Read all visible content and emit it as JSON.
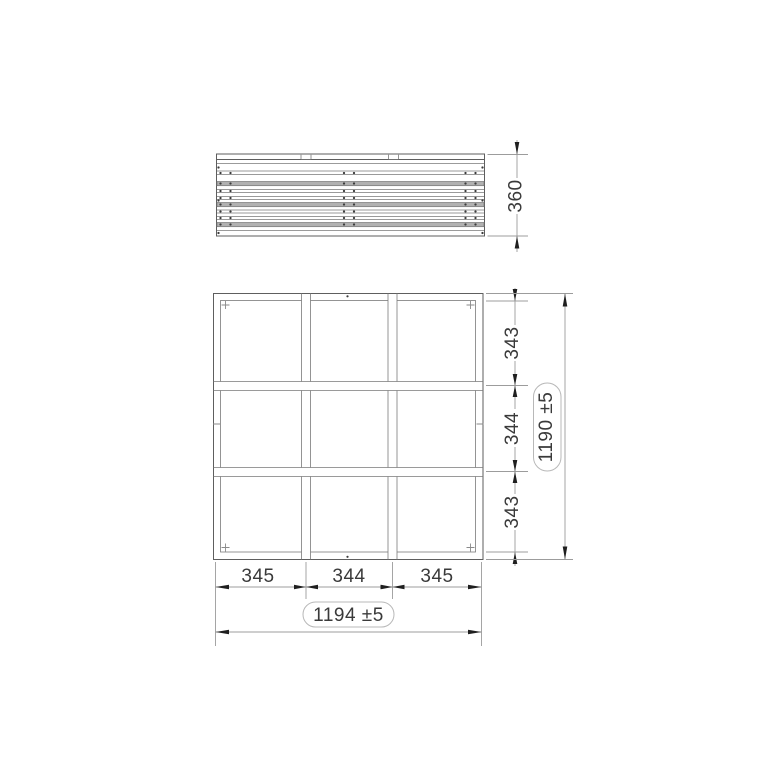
{
  "drawing": {
    "side_view": {
      "depth_dim": "360"
    },
    "plan_view": {
      "row_dims": [
        "343",
        "344",
        "343"
      ],
      "overall_height_dim": "1190 ±5",
      "col_dims": [
        "345",
        "344",
        "345"
      ],
      "overall_width_dim": "1194 ±5"
    },
    "colors": {
      "background": "#ffffff",
      "object_line": "#5e5e5e",
      "dimension_line": "#9c9c9c",
      "arrow": "#1f1f1f",
      "slat_fill": "#b1b1b1",
      "text": "#3a3a3a",
      "pill_border": "#b8b8b8"
    }
  }
}
